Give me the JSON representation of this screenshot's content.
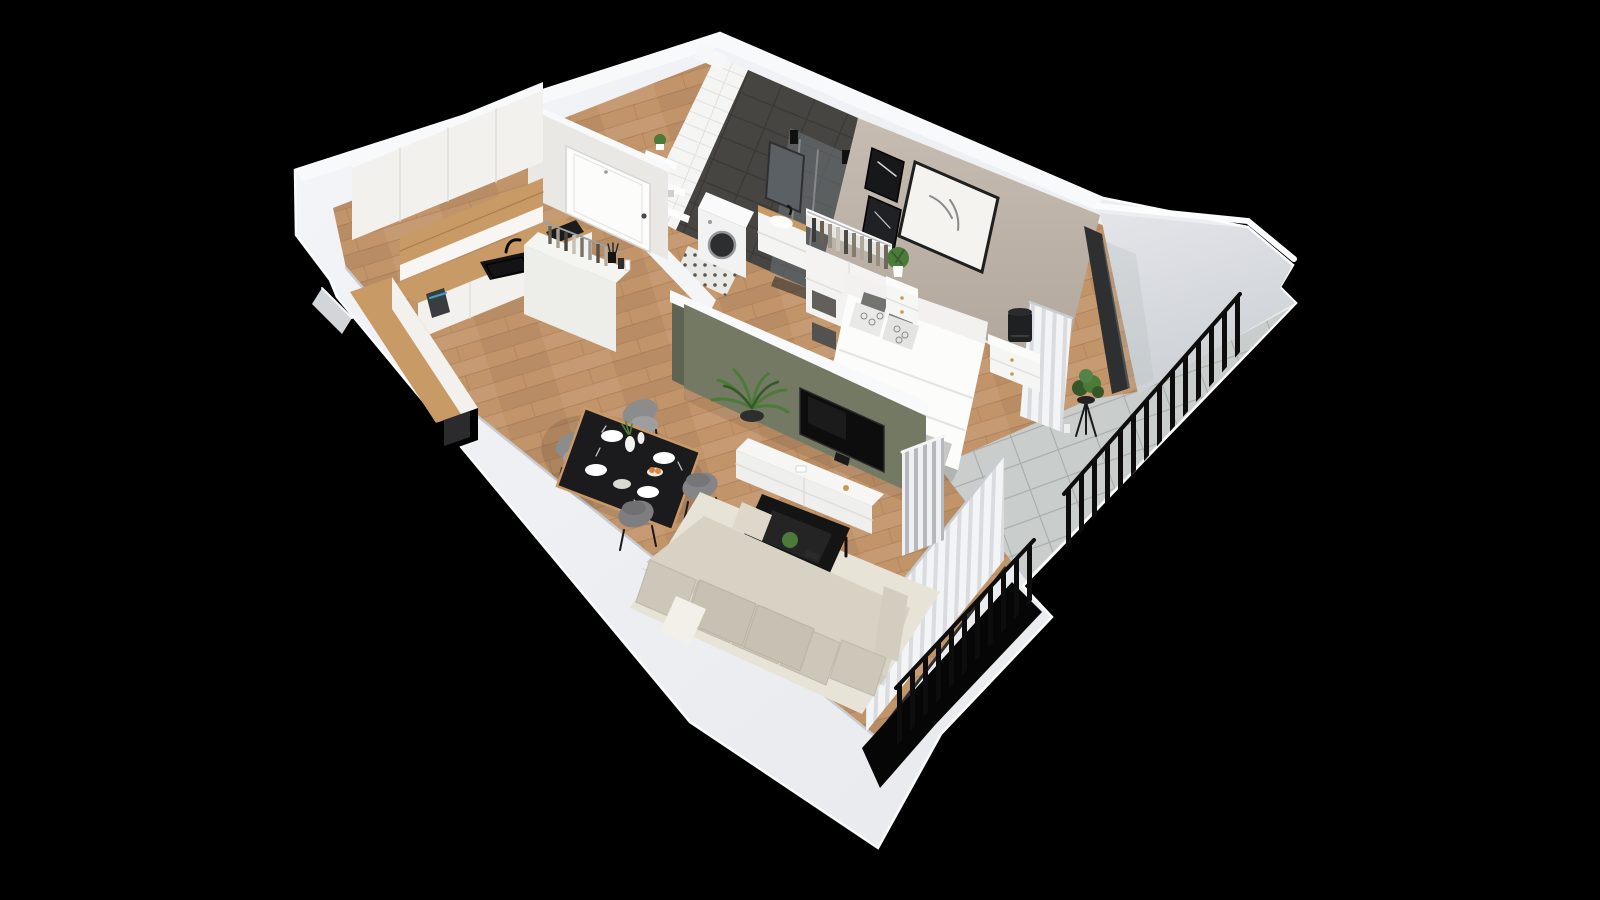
{
  "scene": {
    "label": "3D isometric floor plan render of a one-bedroom apartment with kitchen, hallway, bathroom, bedroom, living-dining room and balcony on a black background"
  },
  "colors": {
    "background": "#000000",
    "shell_white": "#eef0f3",
    "shell_edge": "#fbfcfe",
    "wall_cap": "#f8f9fb",
    "wall_plaster": "#e9e8e4",
    "slab_top": "#e3e5e9",
    "slab_bottom": "#cdd1d6",
    "floor_wood": "#c2946a",
    "floor_wood_line": "#966c44",
    "wood_accent": "#c89a66",
    "cabinet_white": "#f2f1ee",
    "tile_white": "#f5f6f3",
    "tile_white_line": "#dfe1dd",
    "tile_dark": "#474542",
    "tile_dark_line": "#3a3835",
    "glass_shower": "#6d757a",
    "wall_taupe": "#bdb3a8",
    "wall_green": "#747963",
    "wall_green_dark": "#5f6452",
    "balcony_tile": "#c9cdcb",
    "balcony_tile_line": "#a7adab",
    "railing_black": "#0d0d0d",
    "window_frame": "#2e2f31",
    "curtain_light": "#f3f4f6",
    "curtain_shade": "#d9dbdf",
    "sofa_beige": "#d7d2c4",
    "sofa_cushion": "#ccc7b8",
    "sofa_seat": "#c6c1b2",
    "rug_cream": "#e7e3d6",
    "table_black": "#1b1b1d",
    "chair_gray": "#8c8c8c",
    "bed_white": "#fcfcfb",
    "pillow_gray": "#73736f",
    "throw_gray": "#c7c7c5",
    "plant_green": "#4c7a38",
    "plant_dark": "#35582a",
    "fruit_orange": "#dd8030",
    "appliance_dark": "#2b2b2d",
    "knob_gold": "#c59a52"
  },
  "rooms": [
    {
      "name": "kitchen",
      "furniture": [
        "upper cabinets",
        "open wood shelf",
        "wood countertop",
        "black sink with faucet",
        "induction hob",
        "kettle",
        "base cabinets",
        "built-in appliance",
        "peninsula with coat rack"
      ]
    },
    {
      "name": "hallway",
      "furniture": [
        "entry door",
        "coat hangers",
        "wood plank floor"
      ]
    },
    {
      "name": "bathroom",
      "furniture": [
        "washing machine",
        "vanity with basin",
        "mirror",
        "walk-in shower",
        "wall shelves with towels",
        "plant",
        "mosaic tile floor"
      ]
    },
    {
      "name": "bedroom",
      "furniture": [
        "double bed",
        "headboard",
        "patterned pillows",
        "open wardrobe with clothes",
        "two nightstands",
        "table lamp",
        "three wall artworks",
        "curtains",
        "potted plant"
      ]
    },
    {
      "name": "living-dining-room",
      "furniture": [
        "corner sofa",
        "coffee table",
        "cream rug",
        "wall-mounted TV",
        "TV cabinet",
        "dining table set for four",
        "four gray chairs",
        "radiator",
        "curtains",
        "palm plant"
      ]
    },
    {
      "name": "balcony",
      "furniture": [
        "black metal railing",
        "plant stand with shrub",
        "stone tile floor"
      ]
    }
  ]
}
